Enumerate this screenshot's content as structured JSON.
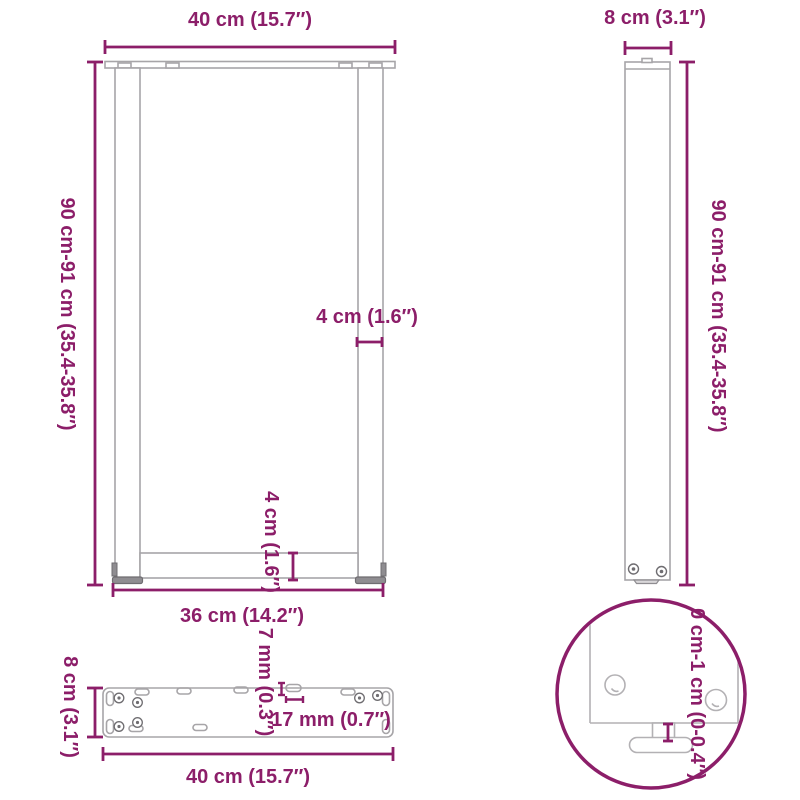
{
  "colors": {
    "accent": "#8C1E69",
    "outline": "#A7A5A8",
    "dark_outline": "#6F6D71"
  },
  "views": {
    "front": {
      "width_label": "40 cm (15.7″)",
      "height_label": "90 cm-91 cm (35.4-35.8″)",
      "leg_thickness_label": "4 cm (1.6″)",
      "crossbar_height_label": "4 cm (1.6″)",
      "inner_width_label": "36 cm (14.2″)"
    },
    "side": {
      "depth_label": "8 cm (3.1″)",
      "height_label": "90 cm-91 cm (35.4-35.8″)"
    },
    "plate": {
      "depth_label": "8 cm (3.1″)",
      "width_label": "40 cm (15.7″)",
      "hole_width_label": "7 mm (0.3″)",
      "hole_length_label": "17 mm (0.7″)"
    },
    "detail": {
      "foot_adjust_label": "0 cm-1 cm (0-0.4″)"
    }
  }
}
